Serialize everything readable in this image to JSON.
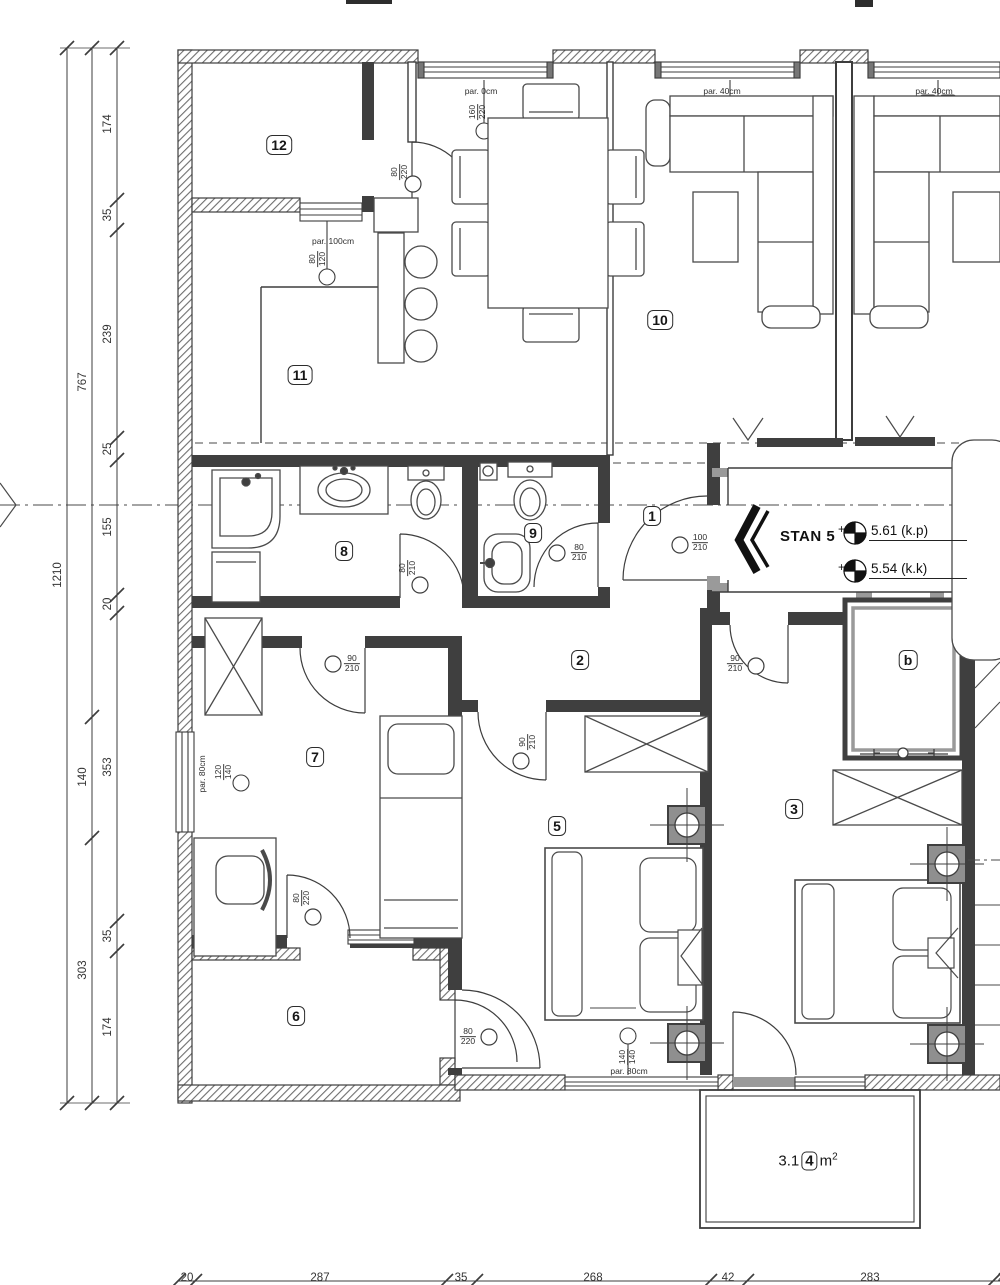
{
  "drawing": {
    "apartment_name": "STAN 5",
    "levels": [
      {
        "plus": "+",
        "value": "5.61",
        "suffix": "(k.p)"
      },
      {
        "plus": "+",
        "value": "5.54",
        "suffix": "(k.k)"
      }
    ],
    "balcony_area": {
      "prefix": "3.1",
      "room_no": "4",
      "unit": "m",
      "exp": "2"
    }
  },
  "rooms": [
    {
      "id": "12"
    },
    {
      "id": "11"
    },
    {
      "id": "10"
    },
    {
      "id": "8"
    },
    {
      "id": "9"
    },
    {
      "id": "1"
    },
    {
      "id": "2"
    },
    {
      "id": "7"
    },
    {
      "id": "5"
    },
    {
      "id": "3"
    },
    {
      "id": "6"
    },
    {
      "id": "b"
    }
  ],
  "door_tags": [
    {
      "w": "80",
      "h": "220"
    },
    {
      "w": "160",
      "h": "220"
    },
    {
      "w": "80",
      "h": "210"
    },
    {
      "w": "80",
      "h": "210"
    },
    {
      "w": "100",
      "h": "210"
    },
    {
      "w": "90",
      "h": "210"
    },
    {
      "w": "90",
      "h": "210"
    },
    {
      "w": "90",
      "h": "210"
    },
    {
      "w": "120",
      "h": "140"
    },
    {
      "w": "80",
      "h": "220"
    },
    {
      "w": "80",
      "h": "220"
    },
    {
      "w": "140",
      "h": "140"
    },
    {
      "w": "80",
      "h": "120"
    }
  ],
  "parapet_tags": [
    "par. 100cm",
    "par. 0cm",
    "par. 40cm",
    "par. 40cm",
    "par. 80cm",
    "par. 80cm"
  ],
  "dimensions": {
    "left_outer": [
      "1210"
    ],
    "left_mid": [
      "767",
      "140",
      "303"
    ],
    "left_inner": [
      "174",
      "35",
      "239",
      "25",
      "155",
      "20",
      "353",
      "35",
      "174"
    ],
    "bottom": [
      "20",
      "287",
      "35",
      "268",
      "42",
      "283",
      "25"
    ]
  }
}
